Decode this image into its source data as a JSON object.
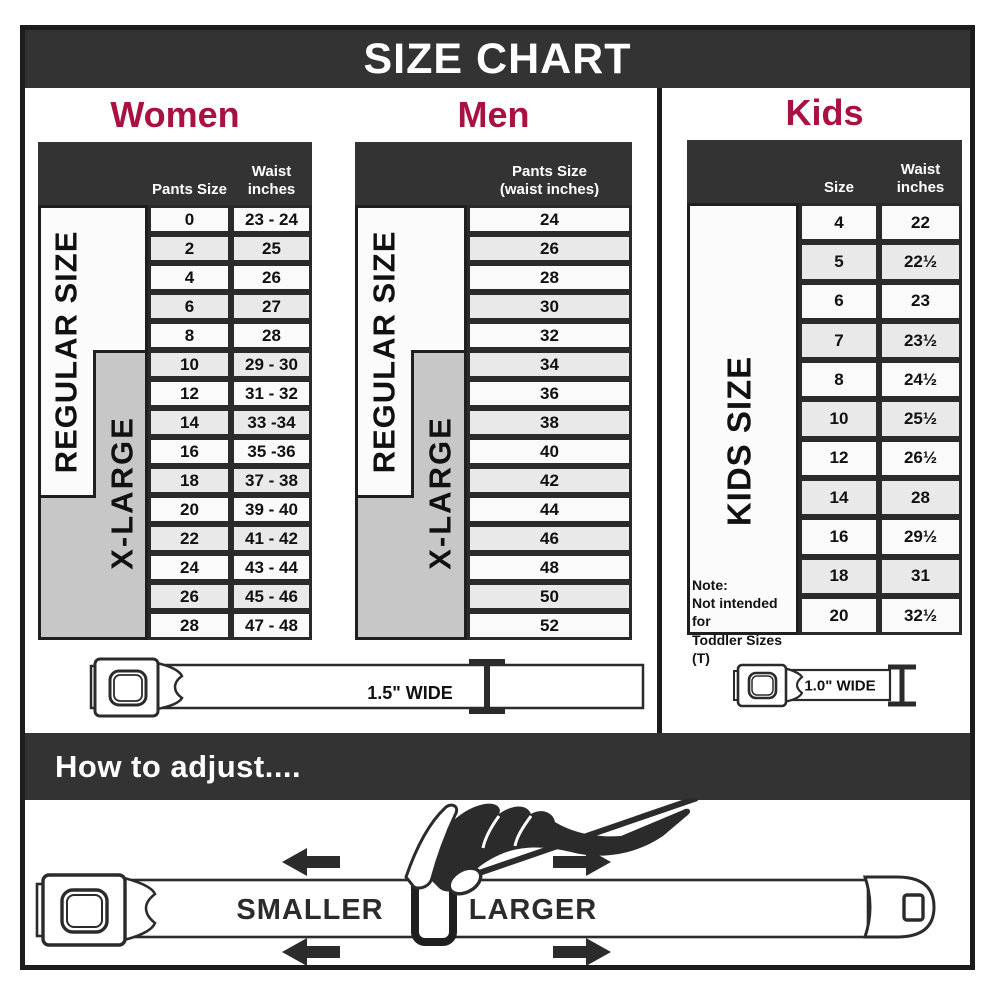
{
  "title": "SIZE CHART",
  "colors": {
    "accent": "#a91240",
    "bar": "#333333",
    "xlarge_gray": "#c7c7c7"
  },
  "women": {
    "heading": "Women",
    "columns": {
      "size": "Pants Size",
      "waist_line1": "Waist",
      "waist_line2": "inches"
    },
    "regular_label": "REGULAR SIZE",
    "xlarge_label": "X-LARGE",
    "rows": [
      {
        "size": "0",
        "waist": "23 - 24"
      },
      {
        "size": "2",
        "waist": "25"
      },
      {
        "size": "4",
        "waist": "26"
      },
      {
        "size": "6",
        "waist": "27"
      },
      {
        "size": "8",
        "waist": "28"
      },
      {
        "size": "10",
        "waist": "29 - 30"
      },
      {
        "size": "12",
        "waist": "31 - 32"
      },
      {
        "size": "14",
        "waist": "33 -34"
      },
      {
        "size": "16",
        "waist": "35 -36"
      },
      {
        "size": "18",
        "waist": "37 - 38"
      },
      {
        "size": "20",
        "waist": "39 - 40"
      },
      {
        "size": "22",
        "waist": "41 - 42"
      },
      {
        "size": "24",
        "waist": "43 - 44"
      },
      {
        "size": "26",
        "waist": "45 - 46"
      },
      {
        "size": "28",
        "waist": "47 - 48"
      }
    ]
  },
  "men": {
    "heading": "Men",
    "column_line1": "Pants Size",
    "column_line2": "(waist inches)",
    "regular_label": "REGULAR SIZE",
    "xlarge_label": "X-LARGE",
    "rows": [
      "24",
      "26",
      "28",
      "30",
      "32",
      "34",
      "36",
      "38",
      "40",
      "42",
      "44",
      "46",
      "48",
      "50",
      "52"
    ]
  },
  "kids": {
    "heading": "Kids",
    "columns": {
      "size": "Size",
      "waist_line1": "Waist",
      "waist_line2": "inches"
    },
    "side_label": "KIDS SIZE",
    "note_lines": [
      "Note:",
      "Not intended for",
      "Toddler Sizes (T)"
    ],
    "rows": [
      {
        "size": "4",
        "waist": "22"
      },
      {
        "size": "5",
        "waist": "22½"
      },
      {
        "size": "6",
        "waist": "23"
      },
      {
        "size": "7",
        "waist": "23½"
      },
      {
        "size": "8",
        "waist": "24½"
      },
      {
        "size": "10",
        "waist": "25½"
      },
      {
        "size": "12",
        "waist": "26½"
      },
      {
        "size": "14",
        "waist": "28"
      },
      {
        "size": "16",
        "waist": "29½"
      },
      {
        "size": "18",
        "waist": "31"
      },
      {
        "size": "20",
        "waist": "32½"
      }
    ]
  },
  "belts": {
    "adult_width": "1.5\" WIDE",
    "kids_width": "1.0\" WIDE"
  },
  "adjust": {
    "heading": "How to adjust....",
    "smaller": "SMALLER",
    "larger": "LARGER"
  }
}
